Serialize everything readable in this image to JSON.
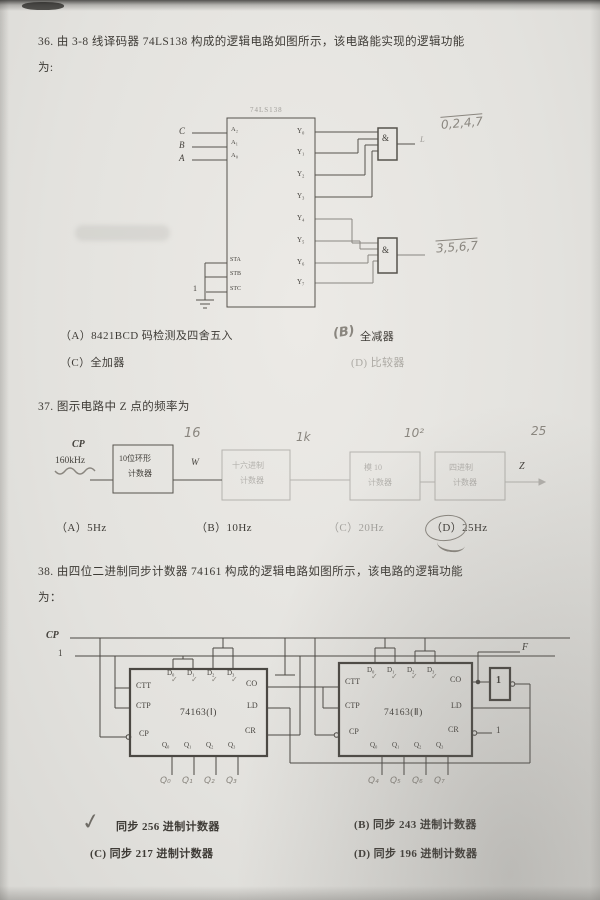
{
  "q36": {
    "stem_line1": "36. 由 3-8 线译码器 74LS138 构成的逻辑电路如图所示，该电路能实现的逻辑功能",
    "stem_line2": "为:",
    "chip": "74LS138",
    "in_c": "C",
    "in_b": "B",
    "in_a": "A",
    "pin_a2": "A₂",
    "pin_a1": "A₁",
    "pin_a0": "A₀",
    "pin_sta": "STA",
    "pin_stb": "STB",
    "pin_stc": "STC",
    "one": "1",
    "outputs": [
      "Y₀",
      "Y₁",
      "Y₂",
      "Y₃",
      "Y₄",
      "Y₅",
      "Y₆",
      "Y₇"
    ],
    "gate": "&",
    "gate1_out": "L",
    "note1": "0,2,4,7",
    "note2": "3,5,6,7",
    "optA": "（A）8421BCD 码检测及四舍五入",
    "optB_mark": "(B)",
    "optB": "全减器",
    "optC": "（C）全加器",
    "optD": "(D) 比较器"
  },
  "q37": {
    "stem": "37. 图示电路中 Z 点的频率为",
    "cp": "CP",
    "freq": "160kHz",
    "b1l1": "10位环形",
    "b1l2": "计数器",
    "w": "W",
    "b2l1": "十六进制",
    "b2l2": "计数器",
    "b3l1": "模 10",
    "b3l2": "计数器",
    "b4l1": "四进制",
    "b4l2": "计数器",
    "z": "Z",
    "n16": "16",
    "n1k": "1k",
    "n100": "10²",
    "n25": "25",
    "optA": "（A）5Hz",
    "optB": "（B）10Hz",
    "optC": "（C）20Hz",
    "optD": "（D）25Hz"
  },
  "q38": {
    "stem_line1": "38. 由四位二进制同步计数器 74161 构成的逻辑电路如图所示，该电路的逻辑功能",
    "stem_line2": "为：",
    "cp": "CP",
    "one": "1",
    "chip1": "74163(Ⅰ)",
    "chip2": "74163(Ⅱ)",
    "ctt": "CTT",
    "ctp": "CTP",
    "cp_pin": "CP",
    "d_pins": [
      "D₀",
      "D₁",
      "D₂",
      "D₃"
    ],
    "q_pins": [
      "Q₀",
      "Q₁",
      "Q₂",
      "Q₃"
    ],
    "co": "CO",
    "ld": "LD",
    "cr": "CR",
    "gate": "1",
    "f": "F",
    "cr_one": "1",
    "check": "✓",
    "hw_q1": [
      "Q₀",
      "Q₁",
      "Q₂",
      "Q₃"
    ],
    "hw_q2": [
      "Q₄",
      "Q₅",
      "Q₆",
      "Q₇"
    ],
    "optA_mark": "✓",
    "optA": "同步 256 进制计数器",
    "optB": "(B) 同步 243 进制计数器",
    "optC": "(C) 同步 217 进制计数器",
    "optD": "(D) 同步 196 进制计数器"
  }
}
